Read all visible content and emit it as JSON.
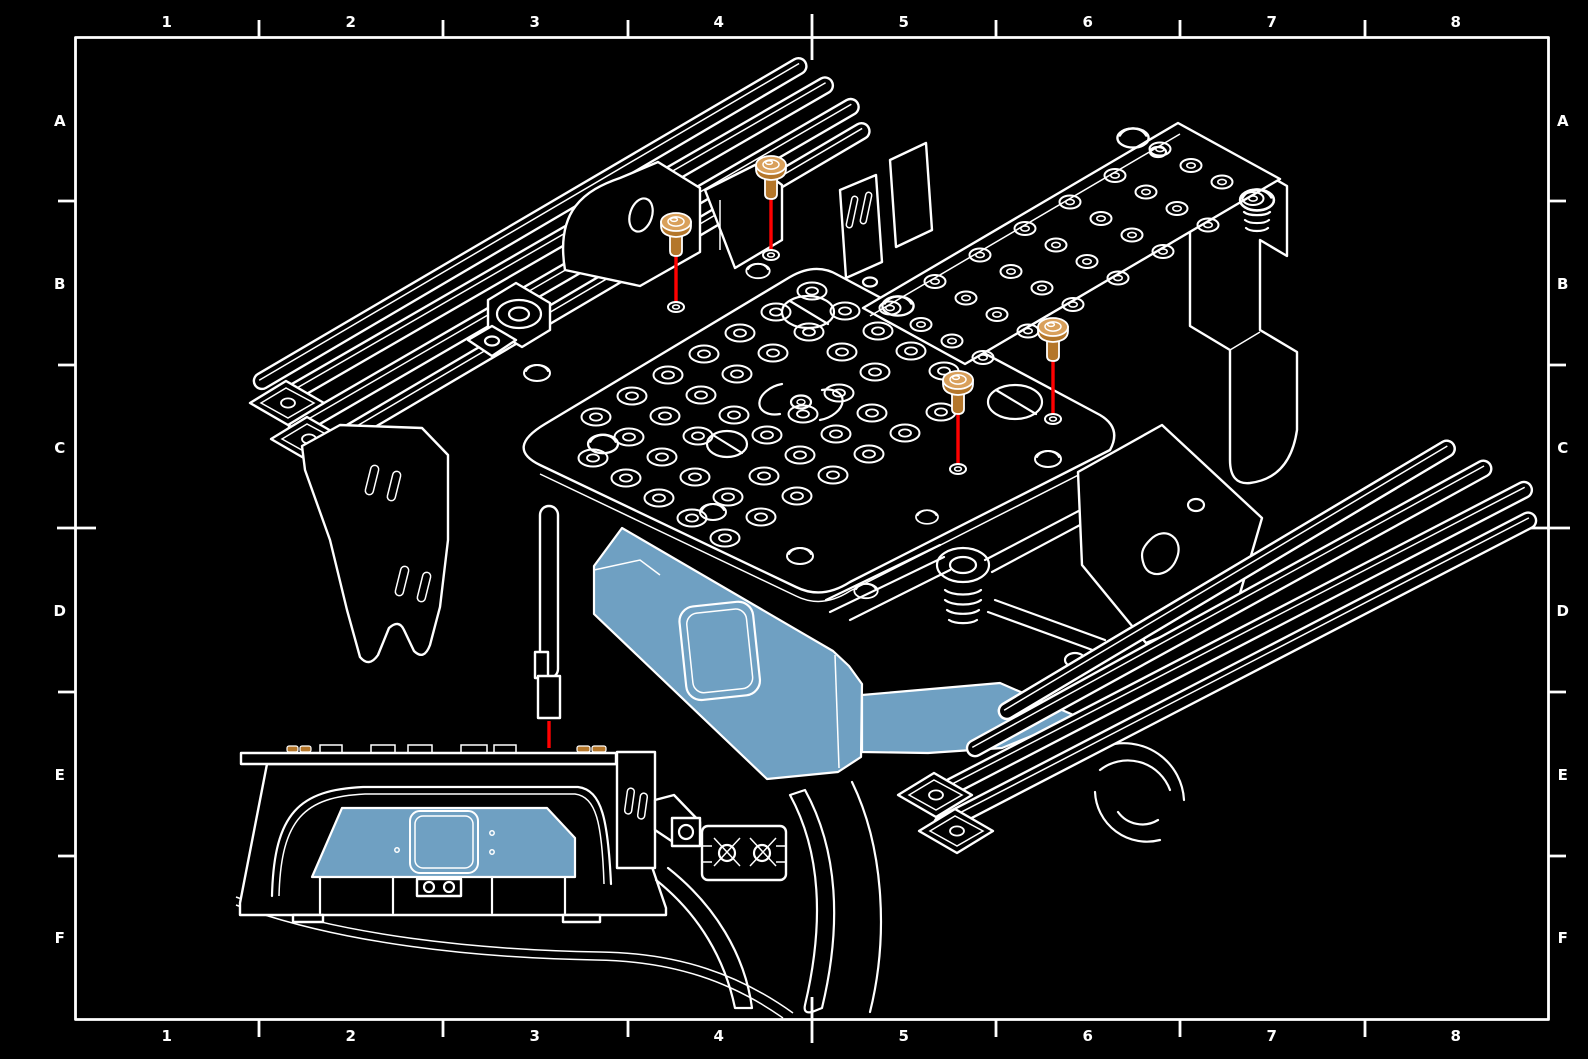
{
  "grid": {
    "columns": [
      "1",
      "2",
      "3",
      "4",
      "5",
      "6",
      "7",
      "8"
    ],
    "rows": [
      "A",
      "B",
      "C",
      "D",
      "E",
      "F"
    ]
  },
  "colors": {
    "background": "#000000",
    "line": "#ffffff",
    "highlight": "#6FA0C2",
    "screw_head": "#D9A05B",
    "screw_body": "#B4762A",
    "leader": "#FF0000"
  }
}
